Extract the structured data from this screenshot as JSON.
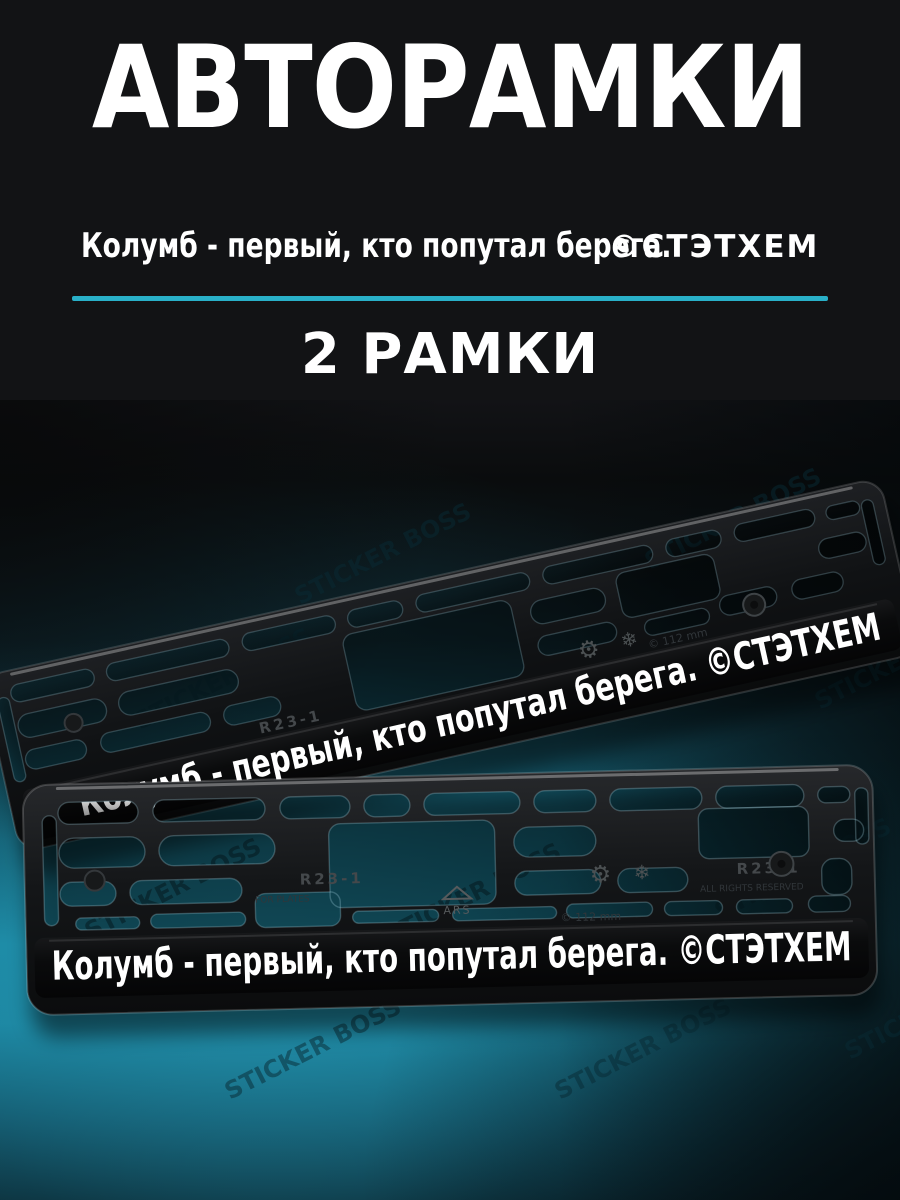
{
  "header": {
    "title": "АВТОРАМКИ",
    "slogan": "Колумб - первый, кто попутал берега.",
    "brand": "©СТЭТХЕМ",
    "count_label": "2 РАМКИ",
    "divider_color": "#29b0c8",
    "background_color": "#121315",
    "text_color": "#ffffff"
  },
  "photo": {
    "background": {
      "teal_bright": "#1d89a4",
      "teal_mid": "#15657a",
      "dark": "#0a0c0d"
    },
    "watermark": "STICKER BOSS",
    "frames": {
      "back": {
        "print": "Колумб - первый, кто попутал берега.   ©СТЭТХЕМ"
      },
      "front": {
        "print": "Колумб - первый, кто попутал берега.   ©СТЭТХЕМ"
      },
      "reflection_fragment": "ый, кто попутал бер"
    },
    "embossed": {
      "model": "R23-1",
      "logo": "ARS",
      "size_note": "© 112 mm",
      "rights": "ALL RIGHTS RESERVED",
      "plates": "FOR PLATES",
      "gear_icon": "⚙",
      "snowflake_icon": "❄"
    }
  }
}
